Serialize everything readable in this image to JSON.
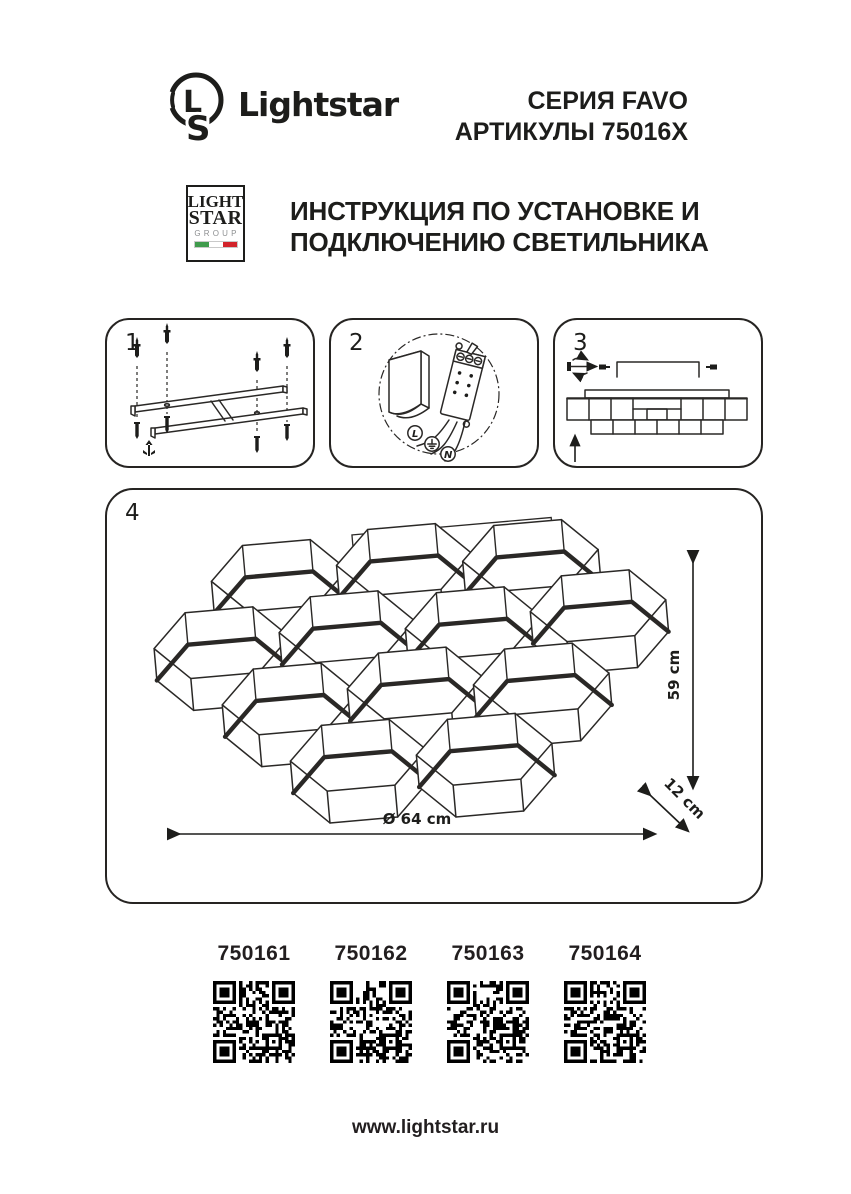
{
  "header": {
    "brand": "Lightstar",
    "series": "СЕРИЯ FAVO",
    "articles": "АРТИКУЛЫ 75016X"
  },
  "group_logo": {
    "line1": "LIGHT",
    "line2": "STAR",
    "line3": "GROUP",
    "flag_icon": "italy-flag-icon"
  },
  "instruction_title": {
    "line1": "ИНСТРУКЦИЯ ПО УСТАНОВКЕ И",
    "line2": "ПОДКЛЮЧЕНИЮ СВЕТИЛЬНИКА"
  },
  "steps": [
    {
      "number": "1",
      "diagram": "ceiling-mounting-frame-with-anchors-and-screws"
    },
    {
      "number": "2",
      "diagram": "terminal-block-wiring"
    },
    {
      "number": "3",
      "diagram": "fixture-attachment-side-view"
    },
    {
      "number": "4",
      "diagram": "honeycomb-lamp-dimensions"
    }
  ],
  "wiring": {
    "phase_label": "L",
    "neutral_label": "N",
    "ground_icon": "earth-ground-icon"
  },
  "dimensions": {
    "height": "59 cm",
    "depth": "12 cm",
    "diameter": "Ø 64 cm"
  },
  "articles": [
    "750161",
    "750162",
    "750163",
    "750164"
  ],
  "footer": {
    "url": "www.lightstar.ru"
  },
  "colors": {
    "ink": "#1d1d1b",
    "flag_green": "#3f9b4c",
    "flag_white": "#ffffff",
    "flag_red": "#d2232a",
    "group_gray": "#8e9092",
    "qr_black": "#000000"
  }
}
